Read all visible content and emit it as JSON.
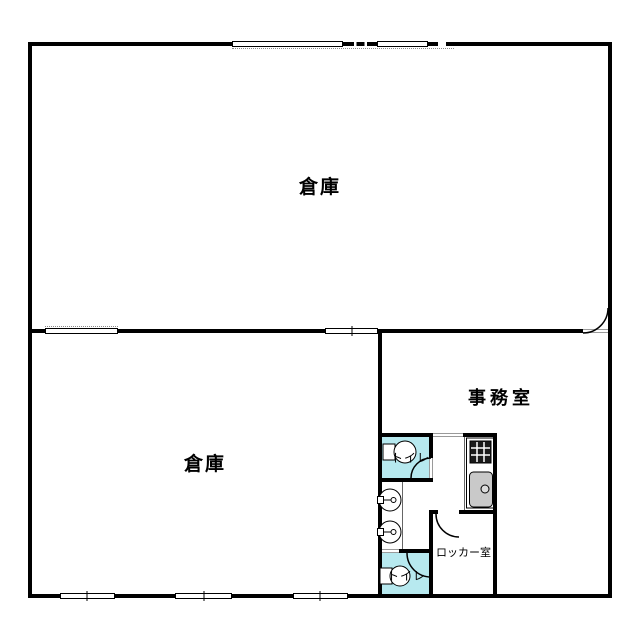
{
  "floorplan": {
    "rooms": {
      "warehouse_upper": {
        "label": "倉庫"
      },
      "warehouse_lower": {
        "label": "倉庫"
      },
      "office": {
        "label": "事務室"
      },
      "toilet_upper": {
        "label": "トイレ"
      },
      "toilet_lower": {
        "label": "トイレ"
      },
      "locker_room": {
        "label": "ロッカー室"
      }
    },
    "fixtures": {
      "toilet_upper": "western-toilet",
      "toilet_lower": "western-toilet",
      "wash_basins": 2,
      "kitchenette": [
        "stove",
        "sink"
      ]
    },
    "openings": {
      "top_wall_windows": 2,
      "top_wall_shutter_dashes": 2,
      "middle_wall_windows": 2,
      "bottom_wall_windows": 3,
      "doors": [
        "office-to-upper-warehouse",
        "toilet-upper",
        "toilet-lower",
        "locker-room"
      ]
    },
    "colors": {
      "wall": "#000000",
      "toilet_floor": "#b7e9ef",
      "sink_gray": "#c9c9c9",
      "stove_dark": "#1a1a1a",
      "background": "#ffffff"
    }
  }
}
